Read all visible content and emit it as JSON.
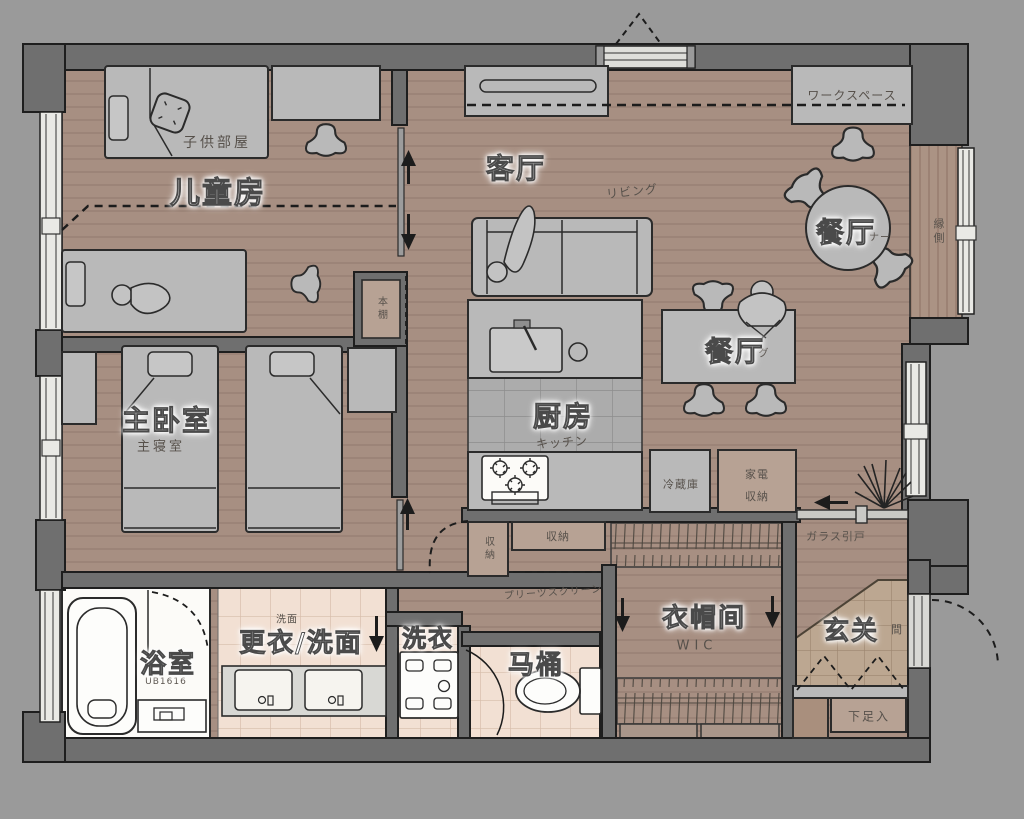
{
  "title": "apartment-floor-plan",
  "colors": {
    "background": "#9a9a9a",
    "wall": "#6f6f6f",
    "outline": "#1e1e1e",
    "wood_floor": "#a78f82",
    "wood_line": "#8a7366",
    "furniture": "#b9b9b9",
    "tile_gray": "#acacac",
    "tile_pink": "#f2e0d3",
    "tile_entry": "#bca791",
    "white_room": "#fcfbf8",
    "tan_box": "#b7a294",
    "label_white": "#ffffff",
    "label_gray": "#57514b"
  },
  "rooms": {
    "children_room": {
      "cn": "儿童房",
      "jp": "子供部屋"
    },
    "living_room": {
      "cn": "客厅",
      "jp": "リビング"
    },
    "dining_corner": {
      "cn": "餐厅",
      "jp_fragment": "ナー"
    },
    "dining_room": {
      "cn": "餐厅",
      "jp_fragment": "グ"
    },
    "master_bedroom": {
      "cn": "主卧室",
      "jp": "主寝室"
    },
    "kitchen": {
      "cn": "厨房",
      "jp": "キッチン"
    },
    "bathroom": {
      "cn": "浴室",
      "jp": "UB1616"
    },
    "dressing_washroom": {
      "cn": "更衣/洗面",
      "jp": "洗面"
    },
    "laundry": {
      "cn": "洗衣"
    },
    "toilet": {
      "cn": "马桶"
    },
    "walk_in_closet": {
      "cn": "衣帽间",
      "jp": "WIC"
    },
    "entryway": {
      "cn": "玄关",
      "jp_fragment": "間"
    }
  },
  "features": {
    "workspace": {
      "jp": "ワークスペース"
    },
    "engawa": {
      "jp": "縁側"
    },
    "refrigerator": {
      "jp": "冷蔵庫"
    },
    "appliance_storage": {
      "jp_line1": "家電",
      "jp_line2": "収納"
    },
    "storage_tall": {
      "jp": "収納"
    },
    "storage_wide": {
      "jp": "収納"
    },
    "bookshelf": {
      "jp": "本棚"
    },
    "glass_sliding_door": {
      "jp": "ガラス引戸"
    },
    "pleated_screen": {
      "jp": "プリーツスクリーン"
    },
    "shoe_cabinet": {
      "jp": "下足入"
    }
  }
}
